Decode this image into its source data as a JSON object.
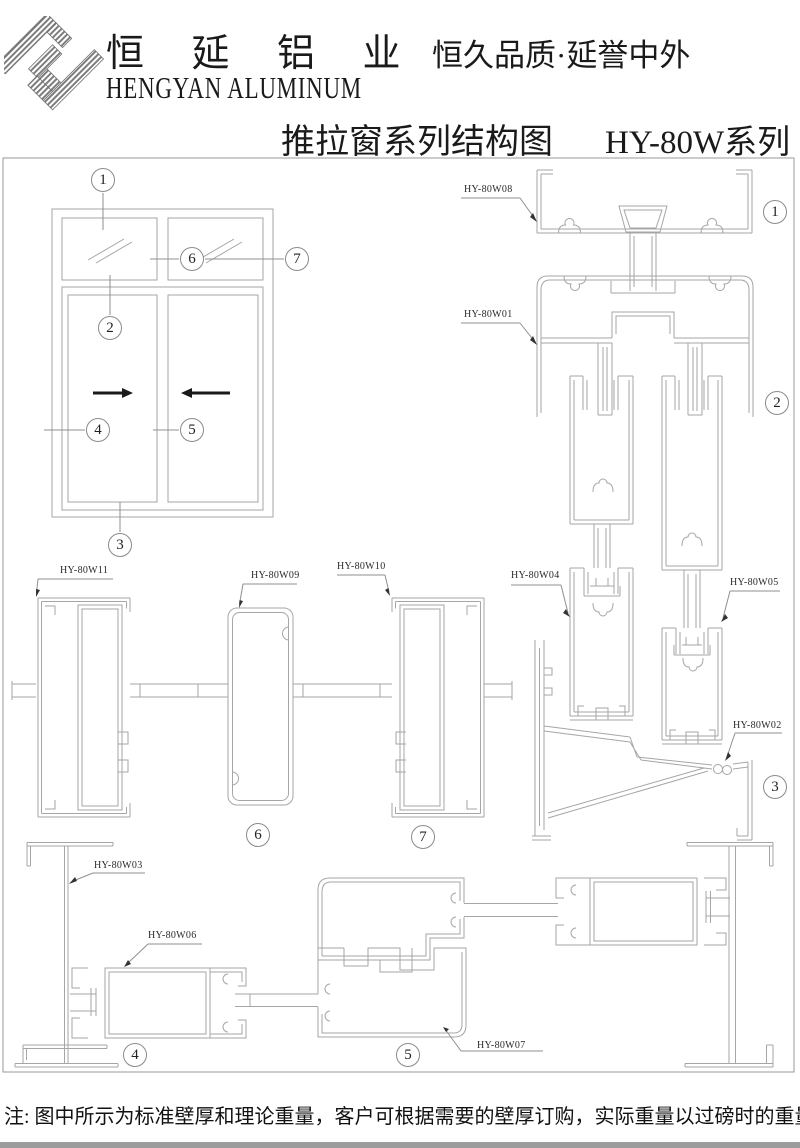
{
  "header": {
    "company_cn": "恒 延 铝 业",
    "company_en": "HENGYAN ALUMINUM",
    "slogan": "恒久品质·延誉中外",
    "title_main": "推拉窗系列结构图",
    "title_series": "HY-80W系列",
    "logo_icon": "hy-monogram-logo"
  },
  "drawing": {
    "description": "sliding-window-profile-structure-diagram",
    "profile_labels": {
      "w01": "HY-80W01",
      "w02": "HY-80W02",
      "w03": "HY-80W03",
      "w04": "HY-80W04",
      "w05": "HY-80W05",
      "w06": "HY-80W06",
      "w07": "HY-80W07",
      "w08": "HY-80W08",
      "w09": "HY-80W09",
      "w10": "HY-80W10",
      "w11": "HY-80W11"
    },
    "callout_numbers": {
      "n1": "1",
      "n2": "2",
      "n3": "3",
      "n4": "4",
      "n5": "5",
      "n6": "6",
      "n7": "7"
    }
  },
  "footer": {
    "note": "注: 图中所示为标准壁厚和理论重量，客户可根据需要的壁厚订购，实际重量以过磅时的重量为准。"
  },
  "colors": {
    "line": "#a6a6a6",
    "leader": "#8f8f8f",
    "border": "#9a9a9a",
    "text": "#1a1a1a",
    "bottom_bar": "#9c9c9c"
  }
}
